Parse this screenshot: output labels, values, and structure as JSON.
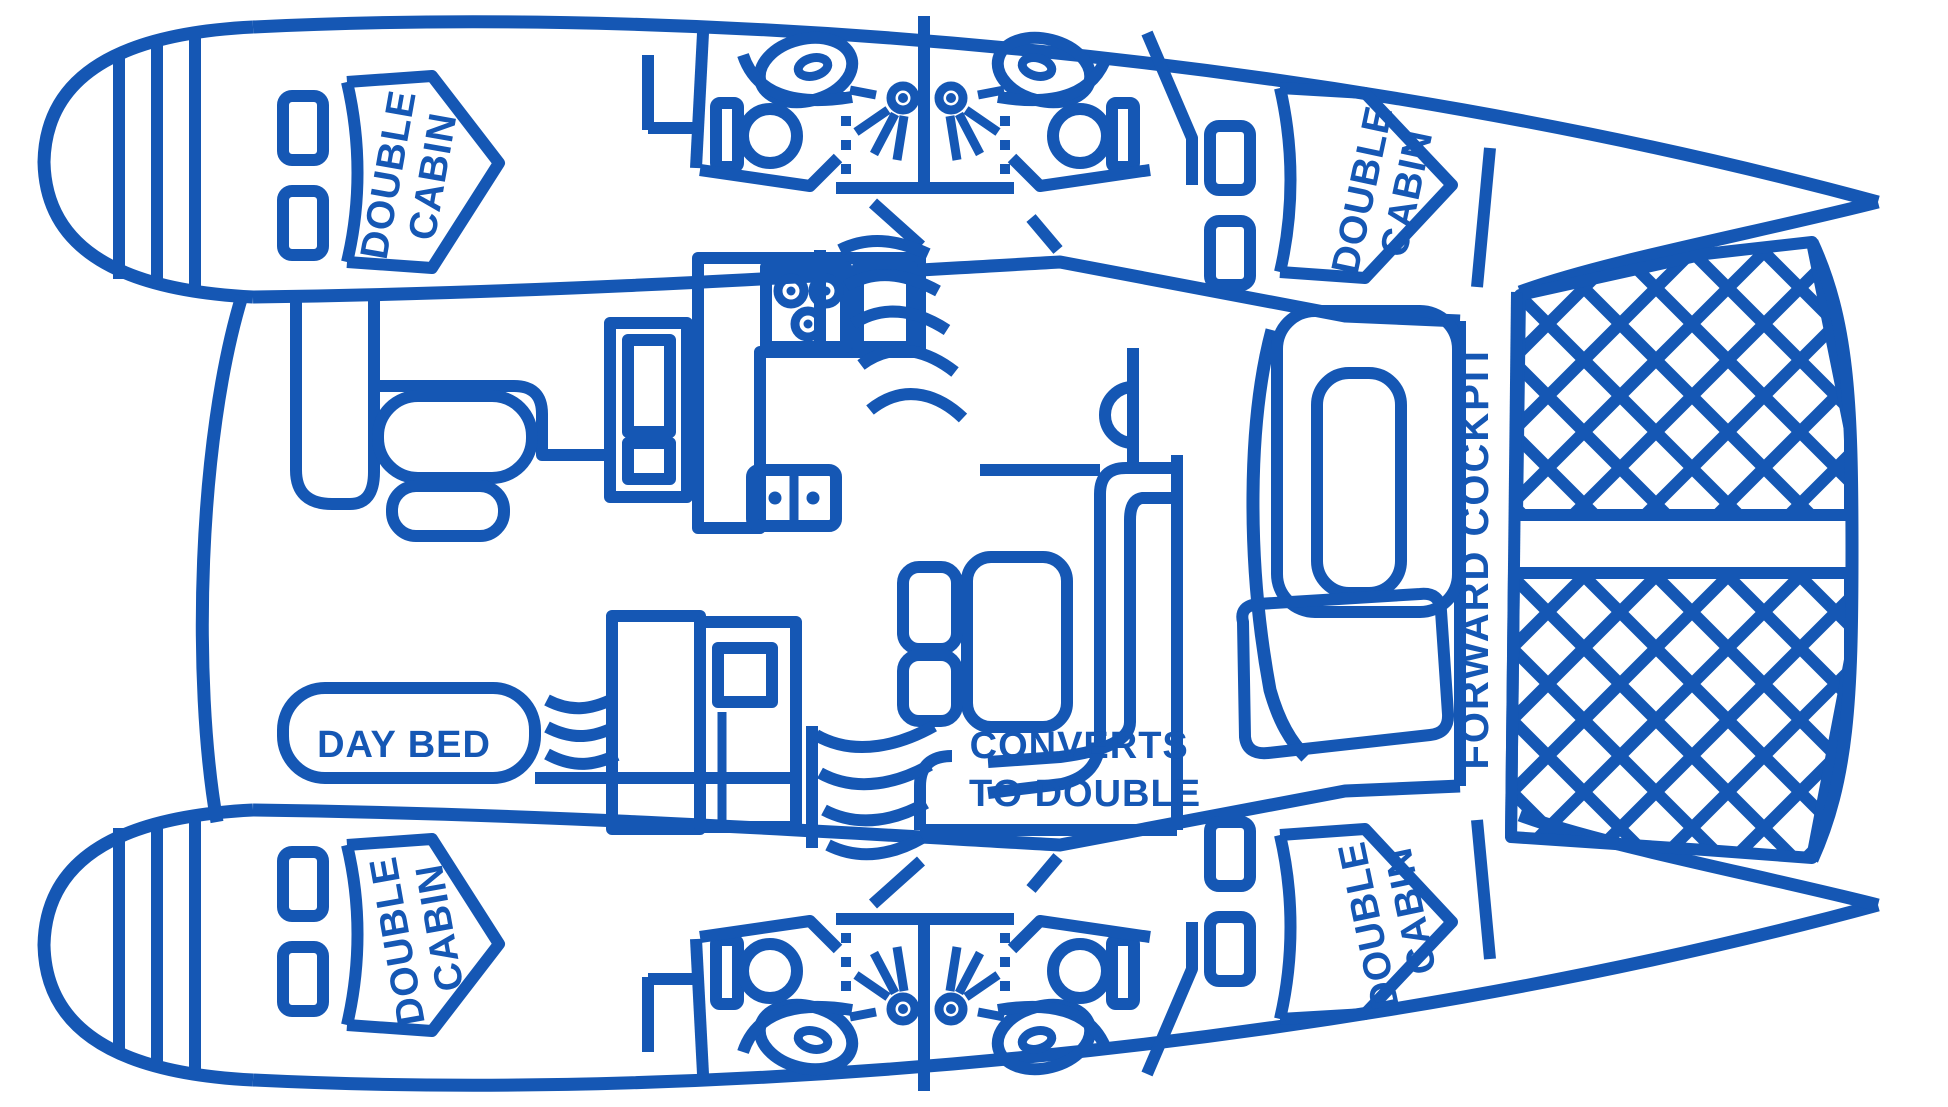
{
  "diagram": {
    "type": "boat-floor-plan",
    "subject": "catamaran interior layout diagram",
    "colors": {
      "line": "#1557b4",
      "background": "#ffffff"
    },
    "labels": {
      "cabin_line1": "DOUBLE",
      "cabin_line2": "CABIN",
      "day_bed": "DAY BED",
      "converts_line1": "CONVERTS",
      "converts_line2": "TO DOUBLE",
      "forward_cockpit": "FORWARD COCKPIT"
    },
    "icons": [
      "toilet-icon",
      "sink-icon",
      "shower-head-icon",
      "stove-icon",
      "stairs-icon",
      "bed-icon",
      "window-icon",
      "trampoline-net-icon",
      "seat-icon",
      "table-icon"
    ]
  }
}
